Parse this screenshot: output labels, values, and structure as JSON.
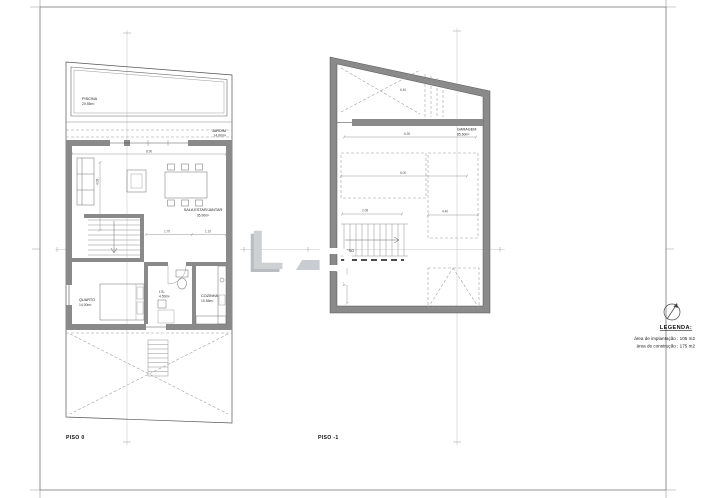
{
  "sheet": {
    "background": "#ffffff",
    "frame_color": "#555555",
    "wall_color": "#8a8a8a"
  },
  "plans": [
    {
      "title": "PISO 0",
      "rooms": [
        {
          "name": "PISCINA",
          "area": "20.55m²"
        },
        {
          "name": "JARDIM",
          "area": "14.60m²"
        },
        {
          "name": "SALA ESTAR/JANTAR",
          "area": "35.90m²"
        },
        {
          "name": "QUARTO",
          "area": "14.00m²"
        },
        {
          "name": "I.S.",
          "area": "4.50m²"
        },
        {
          "name": "COZINHA",
          "area": "10.55m²"
        }
      ],
      "dimensions": [
        "8.90",
        "4.08",
        "1.70",
        "1.10"
      ]
    },
    {
      "title": "PISO -1",
      "rooms": [
        {
          "name": "GARAGEM",
          "area": "85.60m²"
        },
        {
          "name": "ACESSO",
          "area": ""
        }
      ],
      "dimensions": [
        "6.40",
        "6.90",
        "6.00",
        "2.08",
        "4.40",
        "3.10"
      ]
    }
  ],
  "legend": {
    "title": "LEGENDA:",
    "items": [
      "área de implantação : 105 m2",
      "área de construção : 175 m2"
    ]
  },
  "watermark": {
    "letters": [
      "L",
      "_",
      "R"
    ]
  }
}
